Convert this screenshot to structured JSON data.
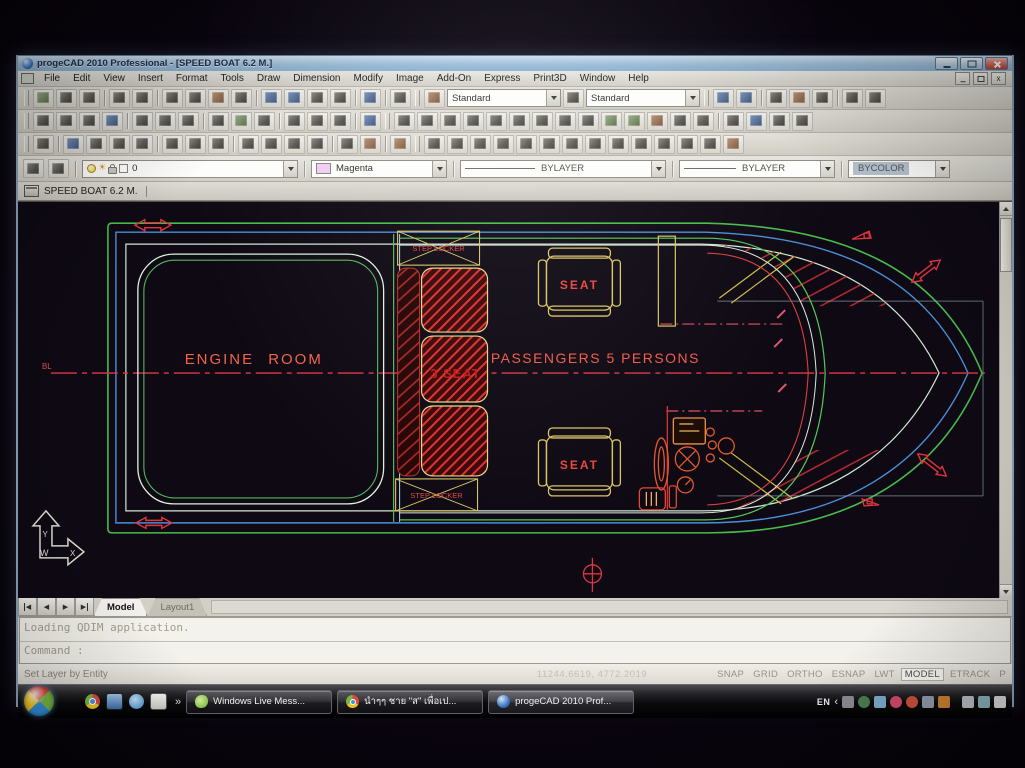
{
  "window": {
    "title": "progeCAD 2010 Professional - [SPEED BOAT 6.2 M.]"
  },
  "menu": {
    "items": [
      "File",
      "Edit",
      "View",
      "Insert",
      "Format",
      "Tools",
      "Draw",
      "Dimension",
      "Modify",
      "Image",
      "Add-On",
      "Express",
      "Print3D",
      "Window",
      "Help"
    ]
  },
  "toolbar": {
    "text_style": "Standard",
    "dim_style": "Standard"
  },
  "properties": {
    "layer_name": "0",
    "color_name": "Magenta",
    "linetype": "BYLAYER",
    "lineweight": "BYLAYER",
    "plot_style": "BYCOLOR"
  },
  "doc": {
    "tab_title": "SPEED BOAT 6.2 M."
  },
  "drawing": {
    "engine_room": "ENGINE ROOM",
    "passengers": "PASSENGERS  5  PERSONS",
    "three_seat": "3 SEAT",
    "seat_top": "SEAT",
    "seat_bottom": "SEAT",
    "step_locker_top": "STEP LOCKER",
    "step_locker_bottom": "STEP LOCKER",
    "baseline_label": "BL",
    "ucs_w": "W",
    "ucs_x": "X",
    "ucs_y": "Y",
    "colors": {
      "hull_outer": "#46bb4c",
      "hull_inner": "#4a8fd8",
      "gunwale": "#cfe9d4",
      "entity_red": "#e0333c",
      "label_red": "#f2644a",
      "seat_yellow": "#d9c565",
      "background": "#0e0913"
    }
  },
  "sheet_tabs": {
    "model": "Model",
    "layout1": "Layout1"
  },
  "command": {
    "history_line": "Loading QDIM application.",
    "prompt": "Command :"
  },
  "status": {
    "message": "Set Layer by Entity",
    "coordinates": "11244.6619, 4772.2019",
    "toggles": [
      "SNAP",
      "GRID",
      "ORTHO",
      "ESNAP",
      "LWT",
      "MODEL",
      "ETRACK",
      "P"
    ]
  },
  "taskbar": {
    "buttons": [
      {
        "label": "Windows Live Mess..."
      },
      {
        "label": "นำๆๆ ชาย \"ส\" เพื่อเป..."
      },
      {
        "label": "progeCAD 2010 Prof..."
      }
    ],
    "tray_language": "EN",
    "quicklaunch_overflow": "»",
    "tray_chevron": "‹"
  },
  "icons": {
    "sun": "☀",
    "nav_prev": "◀",
    "nav_next": "▶"
  }
}
